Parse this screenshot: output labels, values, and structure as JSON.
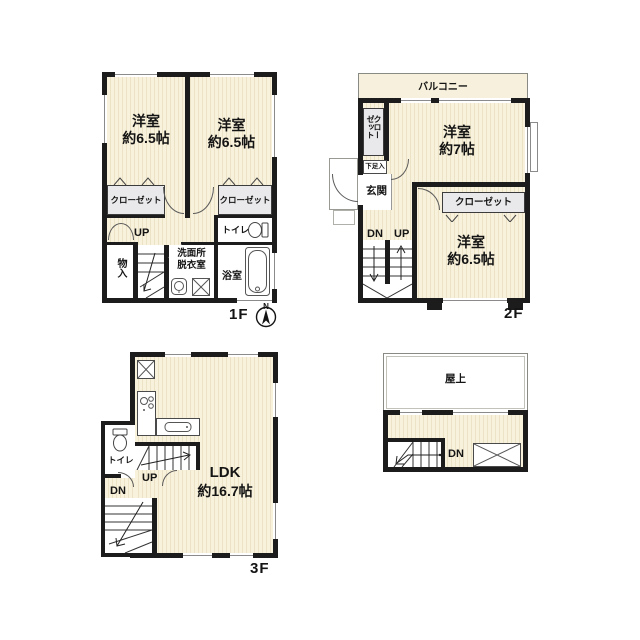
{
  "title": "3-story house floor plan (1F / 2F / 3F / roof)",
  "colors": {
    "wall": "#1c1c1c",
    "room_fill": "#f8f1db",
    "room_stripe": "#ece2c6",
    "closet_fill": "#e9e8ea",
    "balcony_fill": "#f6f0dc",
    "background": "#ffffff"
  },
  "f1": {
    "floor_label": "1F",
    "compass_n": "N",
    "room_left_name": "洋室",
    "room_left_size": "約6.5帖",
    "room_right_name": "洋室",
    "room_right_size": "約6.5帖",
    "closet_left": "クローゼット",
    "closet_right": "クローゼット",
    "toilet": "トイレ",
    "up": "UP",
    "storage": "物入",
    "washroom_line1": "洗面所",
    "washroom_line2": "脱衣室",
    "bath": "浴室"
  },
  "f2": {
    "floor_label": "2F",
    "balcony": "バルコニー",
    "closet_vertical_col1": "クロー",
    "closet_vertical_col2": "ゼット",
    "shoe_cabinet": "下足入",
    "entrance": "玄関",
    "room_top_name": "洋室",
    "room_top_size": "約7帖",
    "closet": "クローゼット",
    "room_bottom_name": "洋室",
    "room_bottom_size": "約6.5帖",
    "dn": "DN",
    "up": "UP"
  },
  "f3": {
    "floor_label": "3F",
    "toilet": "トイレ",
    "up": "UP",
    "dn": "DN",
    "ldk_name": "LDK",
    "ldk_size": "約16.7帖"
  },
  "roof": {
    "label": "屋上",
    "dn": "DN"
  },
  "icons": {
    "compass": "compass-north-icon",
    "toilet": "toilet-icon",
    "bathtub": "bathtub-icon",
    "stove": "stove-icon",
    "kitchen_sink": "kitchen-sink-icon",
    "washbasin": "washbasin-icon",
    "washing_machine": "washing-machine-icon",
    "cross_box": "cross-box-icon",
    "folding_door": "folding-door-icon",
    "stairs": "stairs-icon"
  }
}
